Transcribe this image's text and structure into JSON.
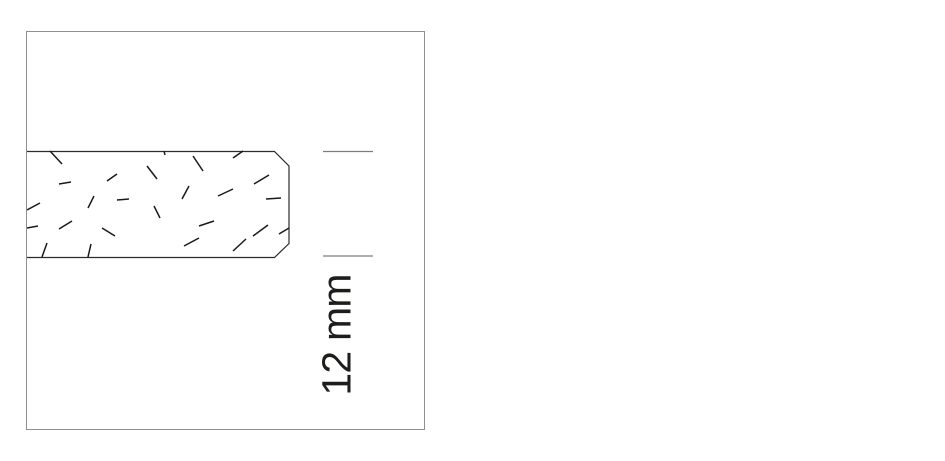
{
  "page": {
    "background": "#ffffff"
  },
  "drawing": {
    "frame": {
      "border_color": "#8f8f8f"
    },
    "board": {
      "description": "panel cross-section with chamfered right edge and particle hatch",
      "fill": "#ffffff",
      "outline_color": "#2b2b2b",
      "outline_path": "M 0,119.5 L 247.5,119.5 L 262,134 L 262,211.5 L 247.5,225.5 L 0,225.5",
      "hatch_color": "#1a1a1a",
      "hatch_marks": [
        [
          23,
          119,
          35,
          132
        ],
        [
          32,
          152,
          44,
          150
        ],
        [
          80,
          149,
          90,
          142
        ],
        [
          120,
          134,
          130,
          147
        ],
        [
          67,
          164,
          61,
          176
        ],
        [
          90,
          168,
          102,
          167
        ],
        [
          0,
          178,
          13,
          171
        ],
        [
          127,
          174,
          133,
          186
        ],
        [
          32,
          197,
          45,
          189
        ],
        [
          0,
          196,
          11,
          194
        ],
        [
          75,
          196,
          88,
          204
        ],
        [
          20,
          211,
          15,
          225
        ],
        [
          64,
          212,
          61,
          225
        ],
        [
          137,
          119,
          138,
          123
        ],
        [
          166,
          124,
          176,
          139
        ],
        [
          206,
          126,
          216,
          119
        ],
        [
          227,
          152,
          242,
          143
        ],
        [
          162,
          154,
          155,
          167
        ],
        [
          191,
          164,
          206,
          157
        ],
        [
          239,
          167,
          254,
          166
        ],
        [
          172,
          194,
          187,
          189
        ],
        [
          226,
          204,
          241,
          193
        ],
        [
          157,
          214,
          172,
          206
        ],
        [
          206,
          219,
          219,
          207
        ],
        [
          252,
          202,
          262,
          196
        ]
      ]
    },
    "dimension": {
      "label": "12 mm",
      "text_color": "#1d1d1b",
      "tick_color": "#7d7d7d",
      "ticks": [
        [
          296,
          119.5,
          346,
          119.5
        ],
        [
          296,
          224,
          346,
          224
        ]
      ]
    }
  }
}
